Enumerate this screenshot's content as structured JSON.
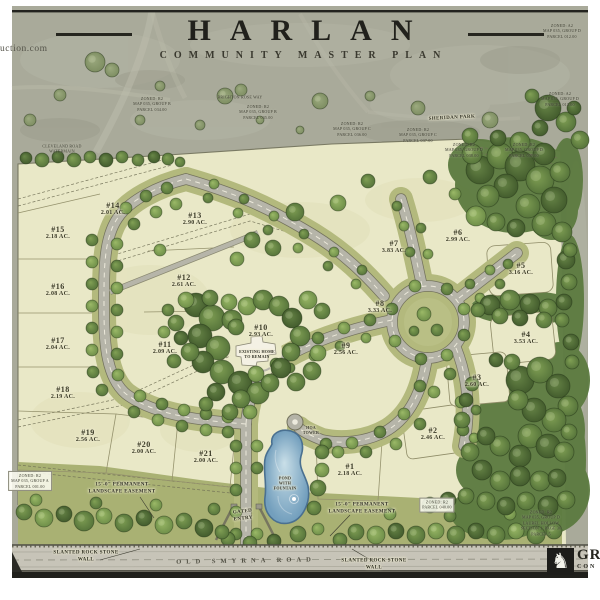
{
  "header": {
    "site_url_fragment": "uction.com",
    "title": "HARLAN",
    "subtitle": "COMMUNITY MASTER PLAN"
  },
  "logo": {
    "icon": "griffin-crest",
    "line1": "GR",
    "line2": "CON"
  },
  "colors": {
    "context_gray_green": "#a9aa9a",
    "site_parchment": "#e9e8c7",
    "street_verge_olive": "#b3b97d",
    "forest_green": "#5d7b41",
    "road_gray": "#b6b5a9",
    "pond_blue": "#7aa6c2",
    "frame_black": "#1f1f1b"
  },
  "lots": [
    {
      "num": "#1",
      "area": "2.18 AC.",
      "x": 350,
      "y": 470
    },
    {
      "num": "#2",
      "area": "2.46 AC.",
      "x": 433,
      "y": 434
    },
    {
      "num": "#3",
      "area": "2.60 AC.",
      "x": 477,
      "y": 381
    },
    {
      "num": "#4",
      "area": "3.53 AC.",
      "x": 526,
      "y": 338
    },
    {
      "num": "#5",
      "area": "3.16 AC.",
      "x": 521,
      "y": 269
    },
    {
      "num": "#6",
      "area": "2.99 AC.",
      "x": 458,
      "y": 236
    },
    {
      "num": "#7",
      "area": "3.83 AC.",
      "x": 394,
      "y": 247
    },
    {
      "num": "#8",
      "area": "3.33 AC.",
      "x": 380,
      "y": 307
    },
    {
      "num": "#9",
      "area": "2.56 AC.",
      "x": 346,
      "y": 349
    },
    {
      "num": "#10",
      "area": "2.93 AC.",
      "x": 261,
      "y": 331
    },
    {
      "num": "#11",
      "area": "2.09 AC.",
      "x": 165,
      "y": 348
    },
    {
      "num": "#12",
      "area": "2.61 AC.",
      "x": 184,
      "y": 281
    },
    {
      "num": "#13",
      "area": "2.90 AC.",
      "x": 195,
      "y": 219
    },
    {
      "num": "#14",
      "area": "2.01 AC.",
      "x": 113,
      "y": 209
    },
    {
      "num": "#15",
      "area": "2.18 AC.",
      "x": 58,
      "y": 233
    },
    {
      "num": "#16",
      "area": "2.08 AC.",
      "x": 58,
      "y": 290
    },
    {
      "num": "#17",
      "area": "2.04 AC.",
      "x": 58,
      "y": 344
    },
    {
      "num": "#18",
      "area": "2.19 AC.",
      "x": 63,
      "y": 393
    },
    {
      "num": "#19",
      "area": "2.56 AC.",
      "x": 88,
      "y": 436
    },
    {
      "num": "#20",
      "area": "2.00 AC.",
      "x": 144,
      "y": 448
    },
    {
      "num": "#21",
      "area": "2.00 AC.",
      "x": 206,
      "y": 457
    }
  ],
  "map_labels": [
    {
      "id": "existing-home-label",
      "style": "tiny",
      "x": 257,
      "y": 354,
      "lines": [
        "EXISTING HOME",
        "TO REMAIN"
      ]
    },
    {
      "id": "pond-label",
      "style": "tiny",
      "x": 285,
      "y": 483,
      "lines": [
        "POND",
        "WITH",
        "FOUNTAIN"
      ]
    },
    {
      "id": "hoa-tower-label",
      "style": "tiny",
      "x": 311,
      "y": 430,
      "lines": [
        "HOA",
        "TOWER"
      ]
    },
    {
      "id": "gated-entry-label",
      "style": "small",
      "x": 243,
      "y": 516,
      "rotate": -6,
      "lines": [
        "GATED",
        "ENTRY"
      ]
    },
    {
      "id": "easement-left-label",
      "style": "small",
      "x": 122,
      "y": 489,
      "lines": [
        "15'-0\" PERMANENT",
        "LANDSCAPE EASEMENT"
      ]
    },
    {
      "id": "easement-right-label",
      "style": "small",
      "x": 362,
      "y": 509,
      "lines": [
        "15'-0\" PERMANENT",
        "LANDSCAPE EASEMENT"
      ]
    },
    {
      "id": "stone-wall-left-label",
      "style": "small",
      "x": 86,
      "y": 557,
      "lines": [
        "SLANTED ROCK STONE",
        "WALL"
      ]
    },
    {
      "id": "stone-wall-right-label",
      "style": "small",
      "x": 374,
      "y": 565,
      "lines": [
        "SLANTED ROCK STONE",
        "WALL"
      ]
    },
    {
      "id": "old-smyrna-road-label",
      "style": "roadname",
      "x": 246,
      "y": 561,
      "rotate": -1,
      "lines": [
        "OLD SMYRNA ROAD"
      ]
    },
    {
      "id": "sheridan-park-label",
      "style": "small",
      "x": 452,
      "y": 119,
      "rotate": -3,
      "lines": [
        "SHERIDAN PARK"
      ]
    },
    {
      "id": "brighton-rose-label",
      "style": "note",
      "x": 240,
      "y": 97,
      "lines": [
        "BRIGHTON ROSE WAY"
      ]
    },
    {
      "id": "cleveland-road-label",
      "style": "note",
      "x": 62,
      "y": 149,
      "lines": [
        "CLEVELAND ROAD",
        "WATERMAIN"
      ]
    },
    {
      "id": "zoning-note-1",
      "style": "note",
      "x": 152,
      "y": 104,
      "lines": [
        "ZONED: R2",
        "MAP 035, GROUP B",
        "PARCEL 034.00"
      ]
    },
    {
      "id": "zoning-note-2",
      "style": "note",
      "x": 258,
      "y": 112,
      "lines": [
        "ZONED: R2",
        "MAP 035, GROUP B",
        "PARCEL 035.00"
      ]
    },
    {
      "id": "zoning-note-3",
      "style": "note",
      "x": 352,
      "y": 129,
      "lines": [
        "ZONED: R2",
        "MAP 035, GROUP C",
        "PARCEL 036.00"
      ]
    },
    {
      "id": "zoning-note-4",
      "style": "note",
      "x": 418,
      "y": 135,
      "lines": [
        "ZONED: R2",
        "MAP 035, GROUP C",
        "PARCEL 037.00"
      ]
    },
    {
      "id": "zoning-note-5",
      "style": "note",
      "x": 464,
      "y": 150,
      "lines": [
        "ZONED: R2",
        "MAP 035, GROUP D",
        "PARCEL 038.00"
      ]
    },
    {
      "id": "zoning-note-6",
      "style": "note",
      "x": 524,
      "y": 150,
      "lines": [
        "ZONED: R2",
        "MAP 035, GROUP D",
        "PARCEL 039.00"
      ]
    },
    {
      "id": "zoning-note-7",
      "style": "note",
      "x": 560,
      "y": 99,
      "lines": [
        "ZONED: A2",
        "MAP 035, GROUP D",
        "PARCEL 013.00"
      ]
    },
    {
      "id": "zoning-note-8",
      "style": "note",
      "x": 562,
      "y": 31,
      "lines": [
        "ZONED: A2",
        "MAP 035, GROUP D",
        "PARCEL 012.00"
      ]
    },
    {
      "id": "zoning-note-left-box",
      "style": "note-boxed",
      "x": 30,
      "y": 481,
      "lines": [
        "ZONED: R2",
        "MAP 035, GROUP A",
        "PARCEL 001.00"
      ]
    },
    {
      "id": "zoning-note-south-box",
      "style": "note-boxed",
      "x": 437,
      "y": 505,
      "lines": [
        "ZONED: R2",
        "PARCEL 040.00"
      ]
    },
    {
      "id": "zoning-note-southeast",
      "style": "note",
      "x": 541,
      "y": 523,
      "lines": [
        "ZONED: R2",
        "MAP 035, GROUP D",
        "LAUREL HOLLOW",
        "SECTION 1, PAGE 30",
        "PARCEL 5"
      ]
    }
  ]
}
